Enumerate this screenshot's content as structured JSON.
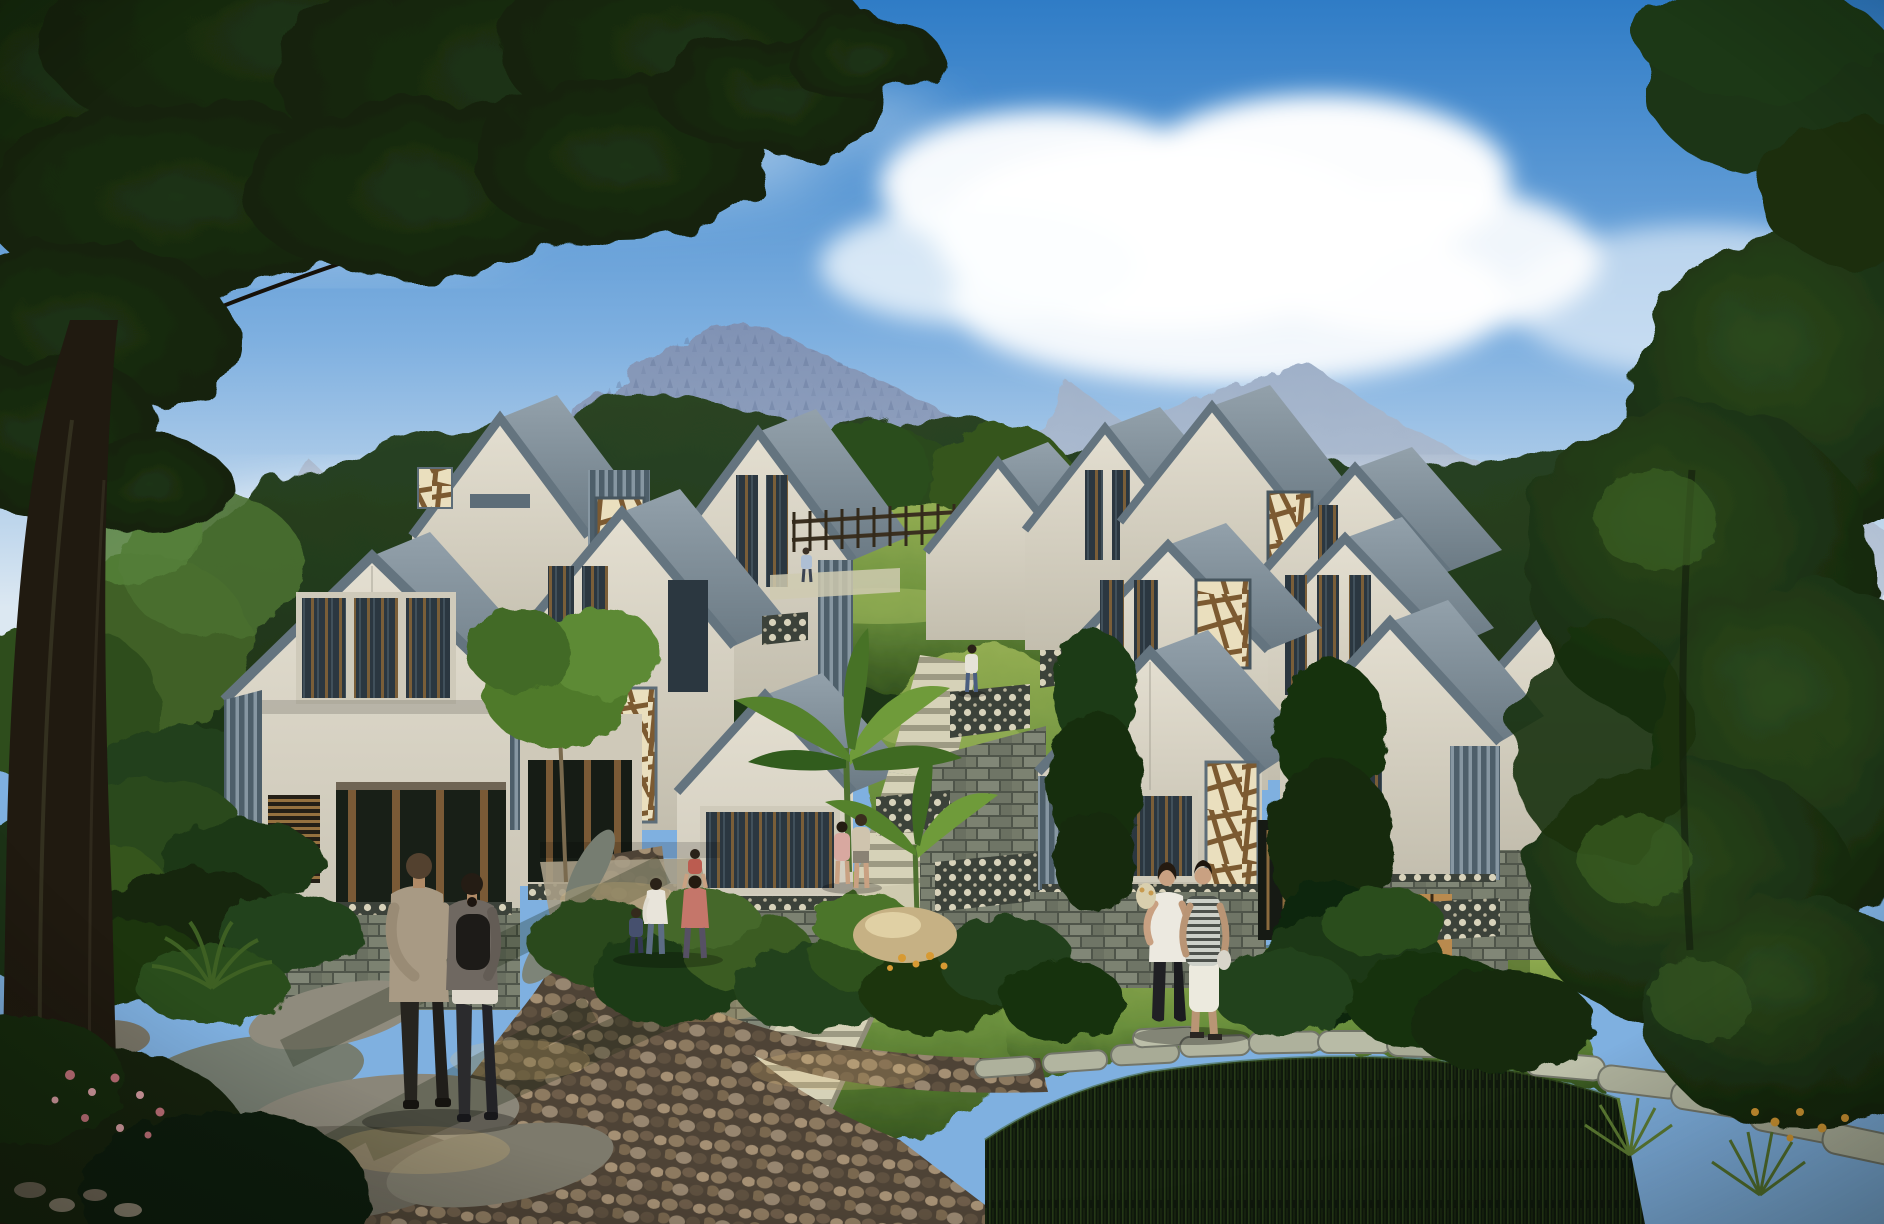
{
  "scene": {
    "title": "hillside-villa-complex-rendering",
    "elements": [
      "sky",
      "clouds",
      "mountains",
      "background-forest",
      "left-villa-cluster",
      "right-villa-cluster",
      "hillside-lawn",
      "central-staircase",
      "retaining-walls",
      "garden-beds",
      "cobblestone-path",
      "stepping-stone-path",
      "reed-pond",
      "foreground-tree",
      "right-tree-mass",
      "people"
    ],
    "villas": {
      "left_cluster_gables": 6,
      "right_cluster_gables": 9,
      "style": "modern-gabled-white-facade-slate-trim-wood-lattice-stone-base"
    },
    "people": [
      {
        "name": "man-walking-foreground",
        "clothing": "tan-jacket-dark-pants"
      },
      {
        "name": "woman-walking-foreground",
        "clothing": "dark-jacket-black-backpack"
      },
      {
        "name": "mother",
        "clothing": "white-top-blue-jeans"
      },
      {
        "name": "child",
        "clothing": "dark-blue-outfit"
      },
      {
        "name": "father-carrying-child",
        "clothing": "pink-red-shirts"
      },
      {
        "name": "couple-on-stairs",
        "clothing": "pink-and-cream-tops"
      },
      {
        "name": "hiker-on-hillside",
        "clothing": "white-shirt-blue-pants"
      },
      {
        "name": "tiny-figure-upper-path",
        "clothing": "light-blue"
      },
      {
        "name": "woman-standing-right",
        "clothing": "white-tank-black-pants"
      },
      {
        "name": "man-standing-right",
        "clothing": "striped-shirt-white-shorts"
      }
    ]
  },
  "colors": {
    "sky_top": "#2f7cc6",
    "sky_mid": "#7fb0e0",
    "sky_horizon": "#dce8f2",
    "cloud_white": "#ffffff",
    "mountain_top": "#8092b4",
    "mountain_base": "#aebdd2",
    "mountain_far": "#9fb0c8",
    "mountain_haze": "#eef3f8",
    "forest_green": "#2a4423",
    "foliage_dark": "#16250f",
    "foliage_mid": "#2f4d1d",
    "foliage_lit": "#4c7429",
    "lawn_lit": "#93ad52",
    "lawn_mid": "#6a8f3c",
    "lawn_dark": "#33521d",
    "facade_lit": "#e4dfd1",
    "facade_shade": "#c3beae",
    "roof_light": "#93a1ab",
    "roof_dark": "#6b7a84",
    "trim_slate": "#64747f",
    "trim_dark": "#47565f",
    "slat_dark": "#4e5f6a",
    "slat_light": "#8797a2",
    "lattice_bg": "#eadfbe",
    "lattice_wood": "#7c5a31",
    "glass_dark": "#2b3740",
    "window_wood": "#8a6a3e",
    "window_warm": "#b98a4e",
    "stone_light": "#7c8271",
    "stone_dark": "#4f554a",
    "screen_dot_cream": "#d8d2ba",
    "screen_bg": "#3c423a",
    "cobble_brown": "#8d7a60",
    "cobble_bg": "#4e4336",
    "flagstone_gray": "#767d71",
    "step_tread": "#d6d2b8",
    "step_riser": "#9d9a83",
    "rock_tan": "#c6b184",
    "rock_gray": "#847f70",
    "reeds_dark": "#0f180c",
    "trunk_brown": "#201a10",
    "flower_pink": "#c4737c",
    "flower_orange": "#d79a33",
    "skin": "#c9a182"
  }
}
